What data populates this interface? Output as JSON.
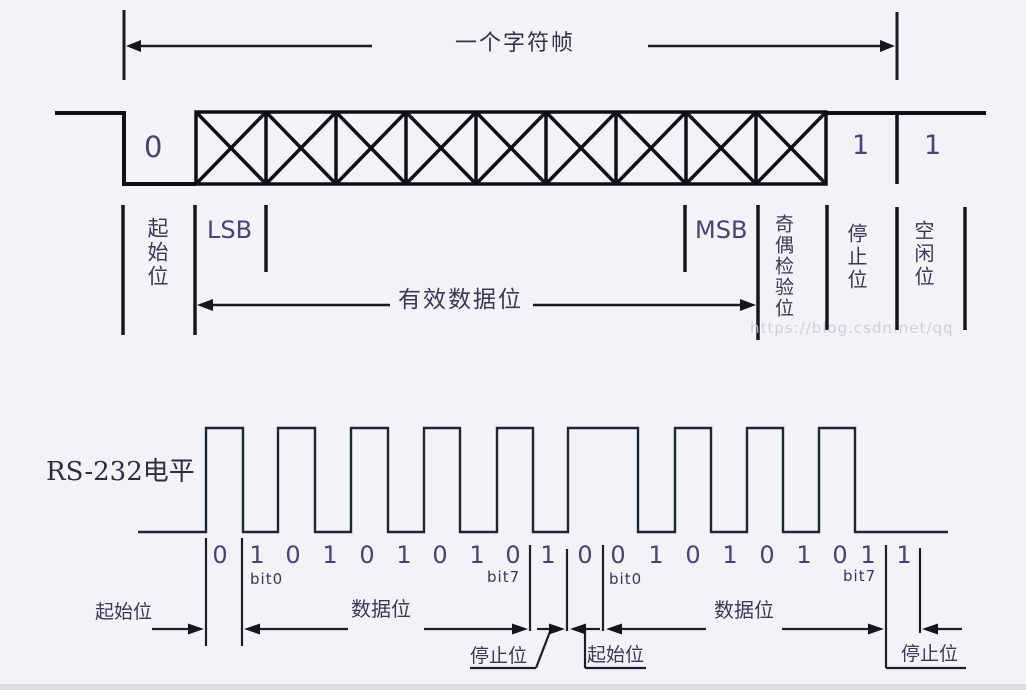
{
  "colors": {
    "background": "#f3f3f7",
    "ink": "#14141f",
    "label_text": "#3e3558",
    "digit_text": "#4c4175",
    "watermark": "#c6c9db"
  },
  "top_frame": {
    "title": "一个字符帧",
    "start_bit_value": "0",
    "stop_bit_value": "1",
    "idle_bit_value": "1",
    "data_box_count": 9,
    "start_label": "起始位",
    "lsb_label": "LSB",
    "msb_label": "MSB",
    "parity_label": "奇偶检验位",
    "stop_label": "停止位",
    "idle_label": "空闲位",
    "data_bits_label": "有效数据位",
    "watermark": "https://blog.csdn.net/qq"
  },
  "waveform": {
    "signal_label": "RS-232电平",
    "bit_values": [
      "0",
      "1",
      "0",
      "1",
      "0",
      "1",
      "0",
      "1",
      "0",
      "1",
      "0",
      "0",
      "1",
      "0",
      "1",
      "0",
      "1",
      "0",
      "1",
      "1"
    ],
    "bit_index_labels": [
      "bit0",
      "bit7",
      "bit0",
      "bit7"
    ],
    "frame1": {
      "start_label": "起始位",
      "data_label": "数据位",
      "stop_label": "停止位"
    },
    "frame2": {
      "start_label": "起始位",
      "data_label": "数据位",
      "stop_label": "停止位"
    }
  }
}
